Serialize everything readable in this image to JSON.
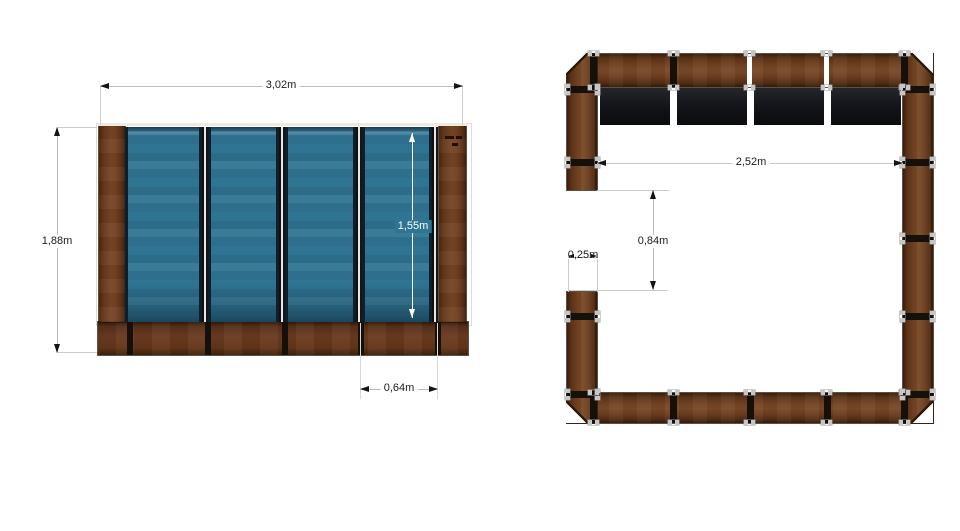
{
  "front_view": {
    "total_width": "3,02m",
    "total_height": "1,88m",
    "glass_height": "1,55m",
    "panel_width": "0,64m",
    "glass_panel_count": 4
  },
  "top_view": {
    "inner_width": "2,52m",
    "opening_depth": "0,84m",
    "wall_thickness": "0,25m",
    "glass_panel_count": 4
  },
  "colors": {
    "wood": "#6e4124",
    "wood_dark": "#3a2112",
    "glass_blue": "#2f7492",
    "joint_black": "#15100a",
    "plan_panel_dark": "#121317",
    "dimension_line": "#bdbdbd",
    "dimension_text": "#1c1c1c",
    "glass_dimension_text": "#ffffff",
    "connector_clip": "#c6c6c6"
  }
}
